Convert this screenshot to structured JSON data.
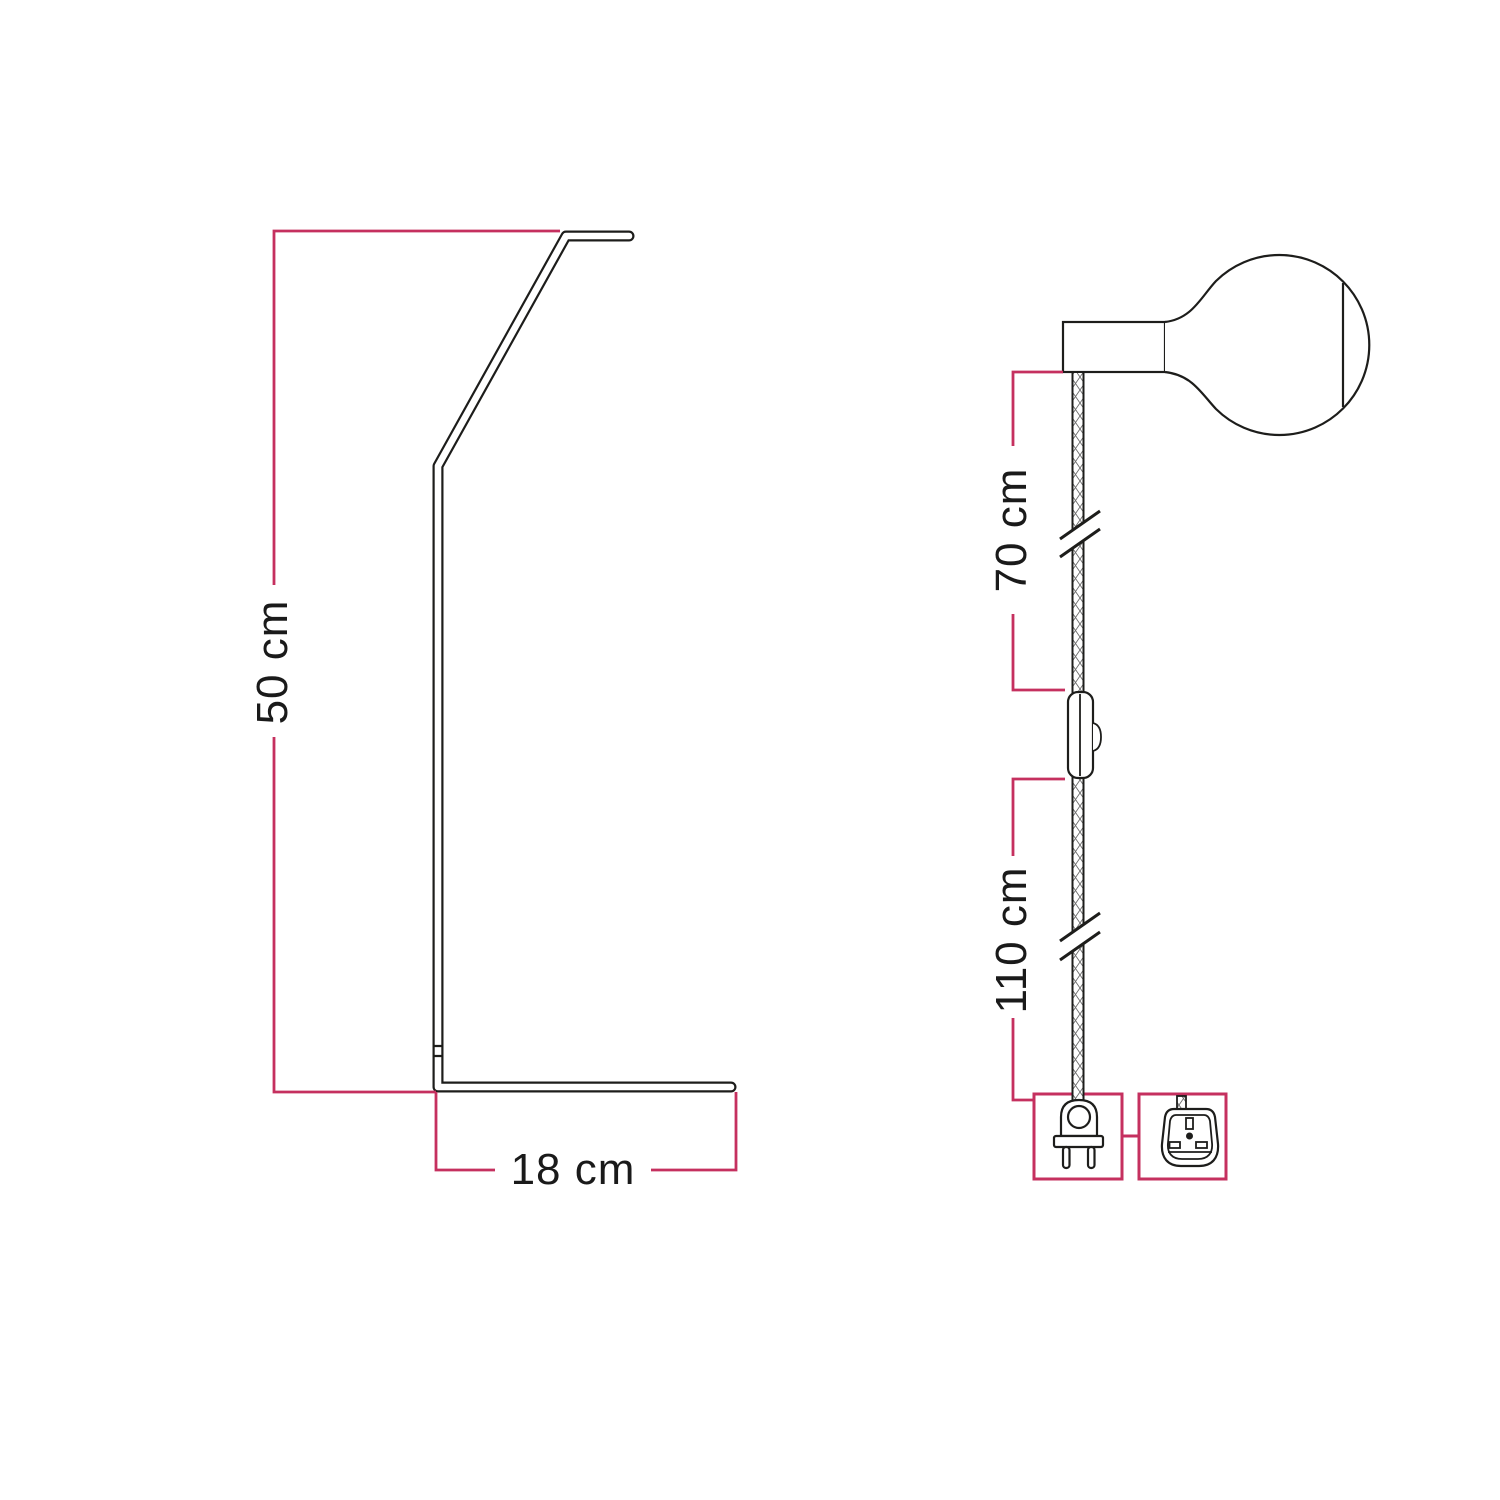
{
  "page": {
    "type": "product-dimension-diagram",
    "background": "#ffffff"
  },
  "colors": {
    "dimension_accent": "#c5305f",
    "drawing_line": "#1d1d1b",
    "label_text": "#1a1a1a"
  },
  "figures": {
    "stand": {
      "name": "lamp-stand-side-view",
      "height_label": "50 cm",
      "base_depth_label": "18 cm"
    },
    "pendant": {
      "name": "pendant-cable-view",
      "upper_cable_label": "70 cm",
      "lower_cable_label": "110 cm",
      "parts": [
        "lamp-socket",
        "globe-bulb",
        "braided-cable",
        "cable-break-marks",
        "inline-switch",
        "euro-two-pin-plug",
        "uk-plug-adapter"
      ]
    }
  }
}
